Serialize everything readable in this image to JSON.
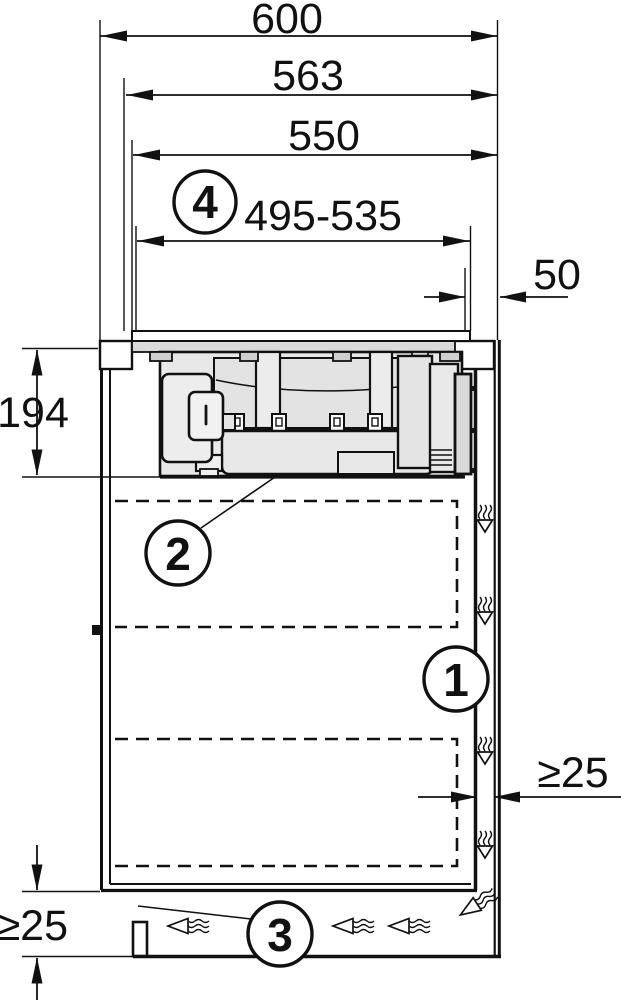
{
  "page": {
    "type": "appliance installation cross-section diagram",
    "background": "#ffffff",
    "line_color": "#111111",
    "body_fill": "#e8e8e8",
    "band_fill": "#d9d9d9",
    "inner_fill": "#efefef"
  },
  "dims": {
    "d600": "600",
    "d563": "563",
    "d550": "550",
    "d495": "495-535",
    "d50": "50",
    "d194": "194",
    "d25r": "≥25",
    "d25b": "≥25"
  },
  "callouts": {
    "c1": "1",
    "c2": "2",
    "c3": "3",
    "c4": "4"
  },
  "icons": {
    "airflow_down": "squiggle-down-arrow",
    "airflow_left": "squiggle-left-arrow",
    "airflow_corner": "squiggle-corner-arrow"
  }
}
